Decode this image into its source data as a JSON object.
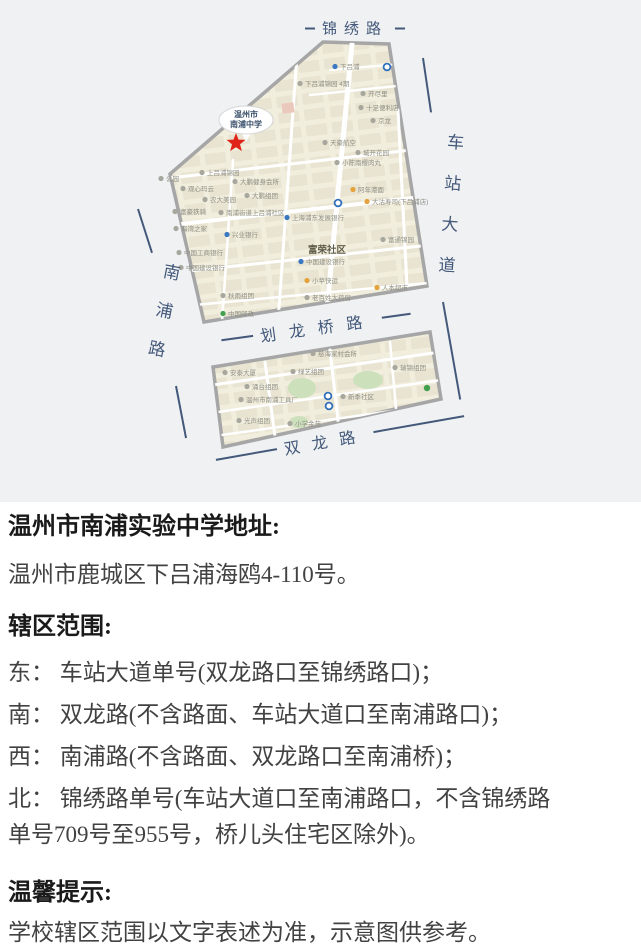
{
  "map": {
    "school_bubble": {
      "line1": "温州市",
      "line2": "南浦中学"
    },
    "community_label": "富荣社区",
    "roads": {
      "top": "锦绣路",
      "right": "车站大道",
      "left": "南浦路",
      "middle": "划龙桥路",
      "bottom": "双龙路"
    },
    "colors": {
      "map_fill": "#f1eede",
      "block": "#e9e4d1",
      "border": "#a6a6a6",
      "road_label": "#44597a",
      "star": "#df2318",
      "park": "#cde0bc"
    },
    "icon_colors": {
      "gray": "#a7a79d",
      "blue": "#3b78c2",
      "green": "#43a04f",
      "orange": "#e3a23c",
      "metro": "#2f6fb8",
      "pin": "#43a04f"
    },
    "pois": [
      {
        "t": "下吕浦",
        "x": 340,
        "y": 69,
        "c": "blue"
      },
      {
        "t": "下吕浦锦园 4期",
        "x": 305,
        "y": 86,
        "c": "gray"
      },
      {
        "t": "开尽里",
        "x": 368,
        "y": 96,
        "c": "gray"
      },
      {
        "t": "十足便利店",
        "x": 366,
        "y": 110,
        "c": "gray"
      },
      {
        "t": "京龙",
        "x": 378,
        "y": 123,
        "c": "gray"
      },
      {
        "t": "天豪航空",
        "x": 330,
        "y": 145,
        "c": "gray"
      },
      {
        "t": "城开花园",
        "x": 363,
        "y": 155,
        "c": "gray"
      },
      {
        "t": "小陈南樱肉丸",
        "x": 342,
        "y": 165,
        "c": "gray"
      },
      {
        "t": "公园",
        "x": 166,
        "y": 181,
        "c": "gray"
      },
      {
        "t": "上吕浦锦园",
        "x": 207,
        "y": 175,
        "c": "gray"
      },
      {
        "t": "大鹏健身会所",
        "x": 240,
        "y": 184,
        "c": "gray"
      },
      {
        "t": "观心玛云",
        "x": 188,
        "y": 191,
        "c": "gray"
      },
      {
        "t": "农大美园",
        "x": 210,
        "y": 202,
        "c": "gray"
      },
      {
        "t": "大鹏组团",
        "x": 252,
        "y": 198,
        "c": "gray"
      },
      {
        "t": "南浦街道上吕浦社区",
        "x": 226,
        "y": 215,
        "c": "gray"
      },
      {
        "t": "富豪铁骑",
        "x": 180,
        "y": 214,
        "c": "gray"
      },
      {
        "t": "海湾之家",
        "x": 181,
        "y": 231,
        "c": "gray"
      },
      {
        "t": "兴业银行",
        "x": 232,
        "y": 237,
        "c": "blue"
      },
      {
        "t": "上海浦东发展银行",
        "x": 292,
        "y": 220,
        "c": "blue"
      },
      {
        "t": "阿年港面",
        "x": 358,
        "y": 192,
        "c": "orange"
      },
      {
        "t": "大沽寿司(下吕浦店)",
        "x": 372,
        "y": 204,
        "c": "orange"
      },
      {
        "t": "富通锦园",
        "x": 388,
        "y": 242,
        "c": "gray"
      },
      {
        "t": "中国工商银行",
        "x": 184,
        "y": 255,
        "c": "gray"
      },
      {
        "t": "中国建设银行",
        "x": 186,
        "y": 270,
        "c": "gray"
      },
      {
        "t": "中国建设银行",
        "x": 306,
        "y": 264,
        "c": "blue"
      },
      {
        "t": "小苹快运",
        "x": 312,
        "y": 283,
        "c": "orange"
      },
      {
        "t": "老百姓大药房",
        "x": 312,
        "y": 300,
        "c": "gray"
      },
      {
        "t": "人本超市",
        "x": 382,
        "y": 290,
        "c": "orange"
      },
      {
        "t": "秋雨组团",
        "x": 228,
        "y": 298,
        "c": "gray"
      },
      {
        "t": "中国邮政",
        "x": 228,
        "y": 316,
        "c": "green"
      },
      {
        "t": "慈海家村会所",
        "x": 318,
        "y": 356,
        "c": "gray"
      },
      {
        "t": "安泰大厦",
        "x": 230,
        "y": 375,
        "c": "gray"
      },
      {
        "t": "绿艺组团",
        "x": 298,
        "y": 374,
        "c": "gray"
      },
      {
        "t": "瑞锦组团",
        "x": 400,
        "y": 370,
        "c": "gray"
      },
      {
        "t": "涌台组团",
        "x": 252,
        "y": 389,
        "c": "gray"
      },
      {
        "t": "温州市南浦工具厂",
        "x": 246,
        "y": 402,
        "c": "gray"
      },
      {
        "t": "新季社区",
        "x": 348,
        "y": 399,
        "c": "gray"
      },
      {
        "t": "光声组团",
        "x": 244,
        "y": 423,
        "c": "gray"
      },
      {
        "t": "小学金苑",
        "x": 295,
        "y": 426,
        "c": "gray"
      }
    ],
    "icons": [
      {
        "x": 387,
        "y": 67,
        "c": "metro"
      },
      {
        "x": 338,
        "y": 203,
        "c": "metro"
      },
      {
        "x": 328,
        "y": 396,
        "c": "metro"
      },
      {
        "x": 329,
        "y": 406,
        "c": "metro"
      },
      {
        "x": 427,
        "y": 388,
        "c": "pin"
      }
    ]
  },
  "article": {
    "address_heading": "温州市南浦实验中学地址:",
    "address": "温州市鹿城区下吕浦海鸥4-110号。",
    "scope_heading": "辖区范围:",
    "scope_lines": [
      "东： 车站大道单号(双龙路口至锦绣路口)；",
      "南： 双龙路(不含路面、车站大道口至南浦路口)；",
      "西： 南浦路(不含路面、双龙路口至南浦桥)；",
      "北： 锦绣路单号(车站大道口至南浦路口，不含锦绣路",
      "单号709号至955号，桥儿头住宅区除外)。"
    ],
    "notice_heading": "温馨提示:",
    "notice": "学校辖区范围以文字表述为准，示意图供参考。"
  }
}
